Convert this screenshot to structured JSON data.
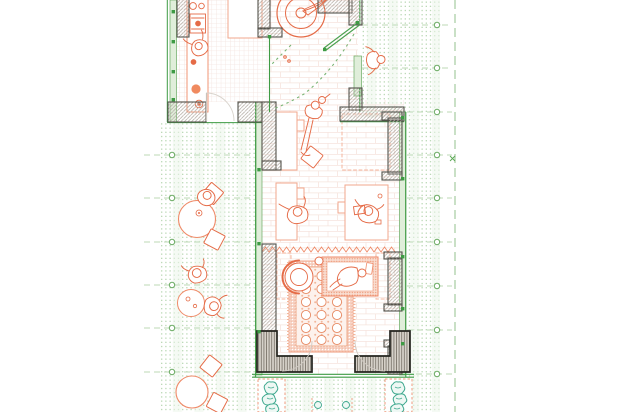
{
  "scene": {
    "type": "architectural-floor-plan",
    "drawing_style": "orange furniture and people, green glazing and landscape hatch, grey hatched masonry walls",
    "rooms": [
      "kitchen-room",
      "round-table-room",
      "studio-room",
      "carpet-lounge"
    ],
    "outdoor_areas": [
      "left-terrace",
      "right-terrace",
      "bottom-walkway",
      "planting-beds"
    ],
    "furniture": [
      "kitchen-counter",
      "prep-table",
      "round-table",
      "wall-desk-upper",
      "wall-desk-lower",
      "side-desk",
      "ornate-carpet",
      "daybed",
      "round-armchair",
      "terrace-table-1",
      "terrace-table-2",
      "terrace-table-3",
      "terrace-chairs"
    ],
    "figures_count": 9,
    "grid": {
      "left_marker_count": 6,
      "right_marker_count": 9,
      "row_spacing_px": 43
    }
  },
  "colors": {
    "paper": "#ffffff",
    "furniture_orange": "#e56b47",
    "light_orange": "#f2a78c",
    "glazing_green": "#3e9b44",
    "glazing_fill": "#e0eeda",
    "terrace_dot_green": "#afd2a9",
    "grid_dash_green": "#bcd9b6",
    "wall_hatch_grey": "#b5aea6",
    "wall_outline": "#54524b",
    "heavy_wall_outline": "#24241f",
    "plant_teal": "#3fa98f",
    "carpet_band": "#f6cdbd",
    "carpet_dot": "#e78a63"
  }
}
